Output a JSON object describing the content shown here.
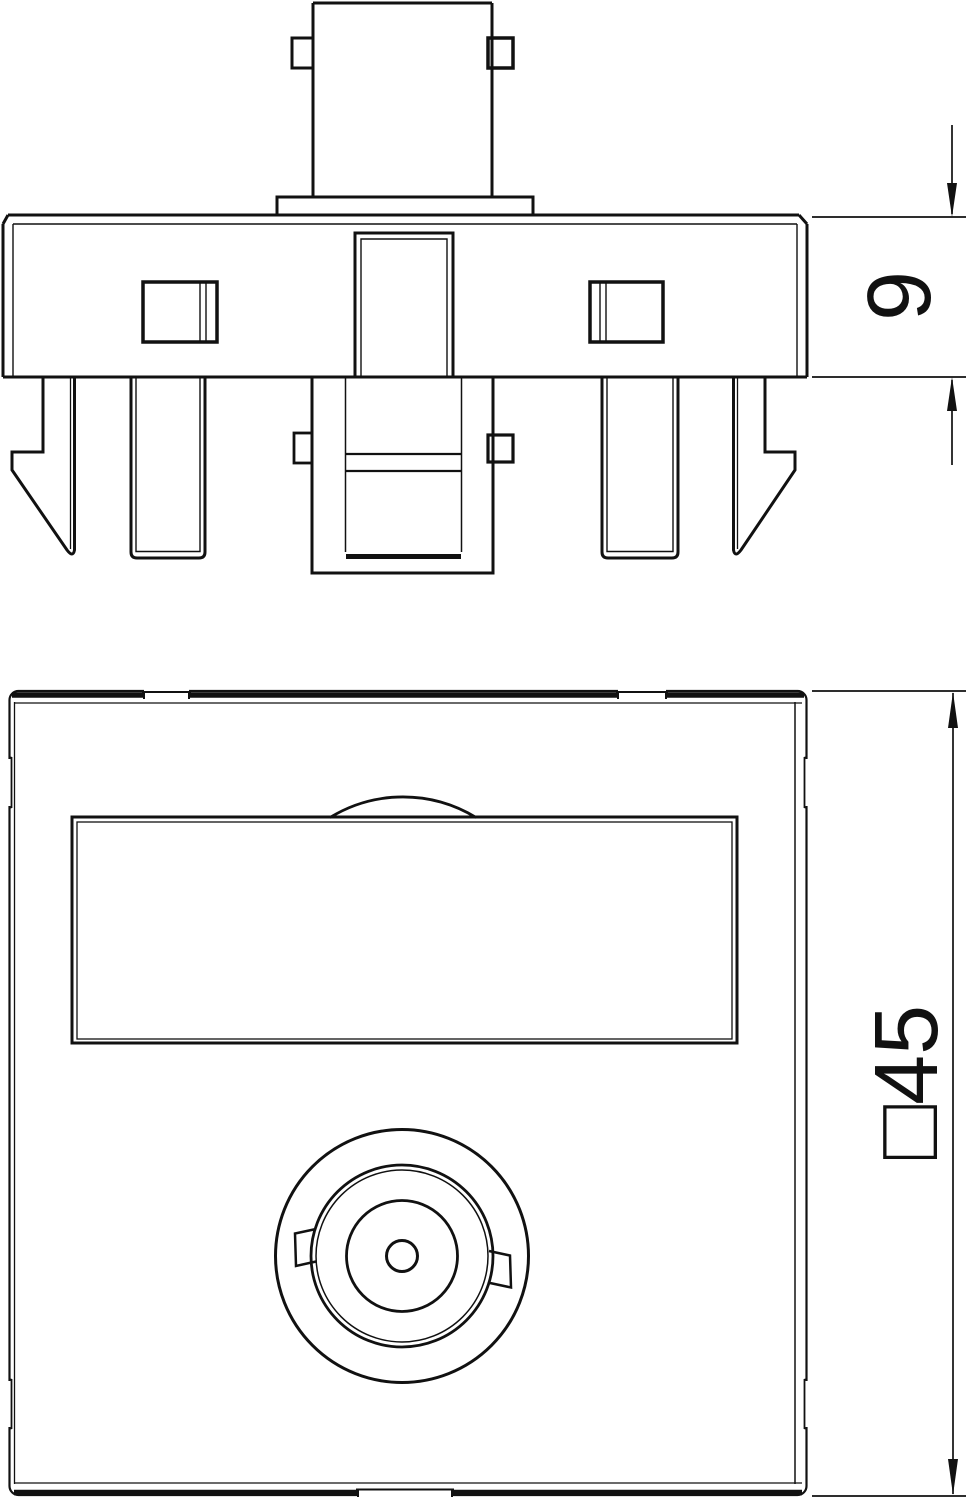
{
  "drawing": {
    "colors": {
      "line": "#111111",
      "background": "#ffffff"
    },
    "side_view": {
      "dimension_label": "9"
    },
    "front_view": {
      "dimension_label": "□45"
    }
  }
}
